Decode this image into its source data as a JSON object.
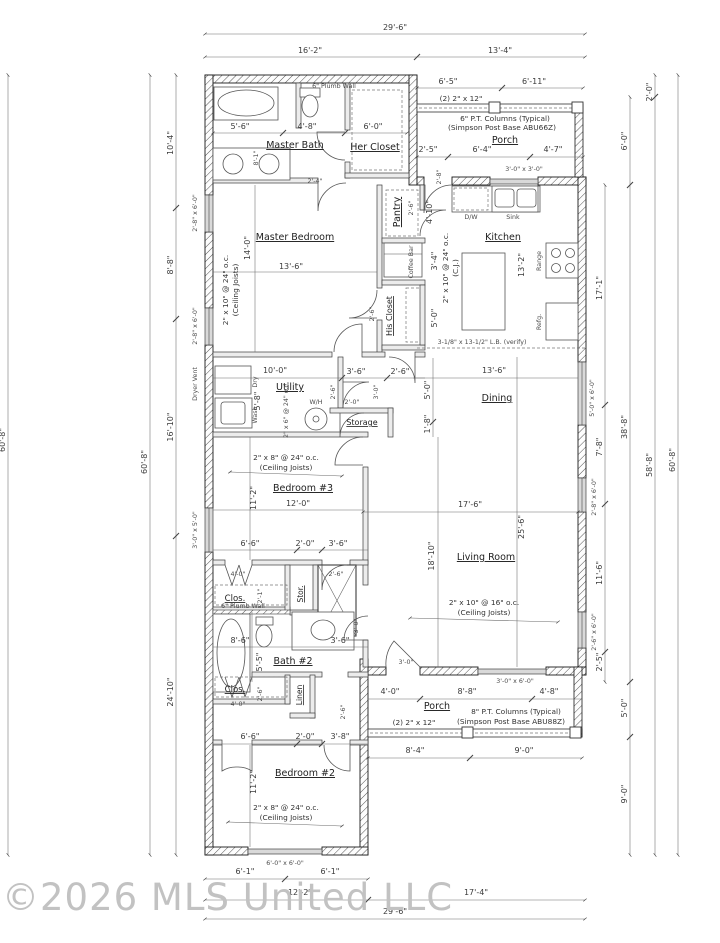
{
  "watermark": "©2026 MLS United LLC",
  "rooms": {
    "master_bath": "Master Bath",
    "her_closet": "Her Closet",
    "master_bedroom": "Master Bedroom",
    "pantry": "Pantry",
    "coffee_bar": "Coffee Bar",
    "his_closet": "His Closet",
    "kitchen": "Kitchen",
    "utility": "Utility",
    "storage": "Storage",
    "dining": "Dining",
    "bedroom3": "Bedroom #3",
    "living_room": "Living Room",
    "closet_top": "Clos.",
    "stor": "Stor.",
    "bath2": "Bath #2",
    "closet_bottom": "Clos.",
    "linen": "Linen",
    "bedroom2": "Bedroom #2",
    "porch_front": "Porch",
    "porch_rear": "Porch"
  },
  "fixtures": {
    "dw": "D/W",
    "sink": "Sink",
    "range": "Range",
    "fridge": "Refg.",
    "water_heater": "W/H",
    "dryer": "Dry",
    "washer": "Wash",
    "dryer_vent": "Dryer Vent"
  },
  "notes": {
    "plumb_wall_top": "6\" Plumb Wall",
    "plumb_wall_mid": "6\" Plumb Wall",
    "beam_front": "(2) 2\" x 12\"",
    "beam_rear": "(2) 2\" x 12\"",
    "col_front_1": "6\" P.T. Columns (Typical)",
    "col_front_2": "(Simpson Post Base ABU66Z)",
    "col_rear_1": "8\" P.T. Columns (Typical)",
    "col_rear_2": "(Simpson Post Base ABU88Z)",
    "lb": "3-1/8\" x 13-1/2\" L.B. (verify)",
    "j_mbr_1": "2\" x 10\" @ 24\" o.c.",
    "j_mbr_2": "(Ceiling Joists)",
    "j_k_1": "2\" x 10\" @ 24\" o.c.",
    "j_k_2": "(C.J.)",
    "j_u": "2\" x 6\" @ 24\" o.c.",
    "j_b3_1": "2\" x 8\" @ 24\" o.c.",
    "j_b3_2": "(Ceiling Joists)",
    "j_lv_1": "2\" x 10\" @ 16\" o.c.",
    "j_lv_2": "(Ceiling Joists)",
    "j_b2_1": "2\" x 8\" @ 24\" o.c.",
    "j_b2_2": "(Ceiling Joists)"
  },
  "windows": {
    "front_3030": "3'-0\" x 3'-0\"",
    "mbr_w1": "2'-8\" x 6'-0\"",
    "mbr_w2": "2'-8\" x 6'-0\"",
    "b3_w": "3'-0\" x 5'-0\"",
    "dining_w": "5'-0\" x 6'-0\"",
    "living_e1": "2'-8\" x 6'-0\"",
    "living_e2": "2'-6\" x 6'-0\"",
    "living_s": "3'-0\" x 6'-0\"",
    "b2_w": "6'-0\" x 6'-0\""
  },
  "dims": {
    "top_total": "29'-6\"",
    "top_left": "16'-2\"",
    "top_right": "13'-4\"",
    "fp_a": "6'-5\"",
    "fp_b": "6'-11\"",
    "fp_c": "2'-5\"",
    "fp_d": "6'-4\"",
    "fp_e": "4'-7\"",
    "r2_0": "2'-0\"",
    "r6_0": "6'-0\"",
    "r17_1": "17'-1\"",
    "r7_8": "7'-8\"",
    "r11_6": "11'-6\"",
    "r2_5": "2'-5\"",
    "r38_8": "38'-8\"",
    "r5_0": "5'-0\"",
    "r9_0": "9'-0\"",
    "r58_8": "58'-8\"",
    "r60_8": "60'-8\"",
    "l60_8a": "60'-8\"",
    "l60_8b": "60'-8\"",
    "l10_4": "10'-4\"",
    "l8_8": "8'-8\"",
    "l16_10": "16'-10\"",
    "l24_10": "24'-10\"",
    "bp8_4": "8'-4\"",
    "bp9_0": "9'-0\"",
    "b6_1a": "6'-1\"",
    "b6_1b": "6'-1\"",
    "b12_2": "12'-2\"",
    "b17_4": "17'-4\"",
    "b29_6": "29'-6\"",
    "mb5_6": "5'-6\"",
    "mb4_8": "4'-8\"",
    "mb6_0": "6'-0\"",
    "mb8_1": "8'-1\"",
    "mb2_4": "2'-4\"",
    "mbr14_0": "14'-0\"",
    "mbr13_6": "13'-6\"",
    "p2_6": "2'-6\"",
    "p4_10": "4'-10\"",
    "cb3_4": "3'-4\"",
    "hc2_6": "2'-6\"",
    "hc5_0": "5'-0\"",
    "k13_2": "13'-2\"",
    "k2_8": "2'-8\"",
    "u10_0": "10'-0\"",
    "u5_8": "5'-8\"",
    "h3_6": "3'-6\"",
    "h2_6": "2'-6\"",
    "hd2_6": "2'-6\"",
    "hd3_0": "3'-0\"",
    "st2_0": "2'-0\"",
    "v5_0": "5'-0\"",
    "v1_8": "1'-8\"",
    "d13_6": "13'-6\"",
    "d17_6": "17'-6\"",
    "d25_6": "25'-6\"",
    "b3_11_2": "11'-2\"",
    "b3_12_0": "12'-0\"",
    "lv18_10": "18'-10\"",
    "lvd3_0": "3'-0\"",
    "c6_6": "6'-6\"",
    "c2_0": "2'-0\"",
    "c3_6": "3'-6\"",
    "c4_0": "4'-0\"",
    "cd2_6": "2'-6\"",
    "c2_1": "2'-1\"",
    "bt8_6": "8'-6\"",
    "bt5_5": "5'-5\"",
    "bt3_6": "3'-6\"",
    "cl2_6": "2'-6\"",
    "cl4_0": "4'-0\"",
    "hs3_0": "3'-0\"",
    "d2_2_6": "2'-6\"",
    "cb6_6": "6'-6\"",
    "cb2_0": "2'-0\"",
    "cb3_8": "3'-8\"",
    "rp4_0": "4'-0\"",
    "rp8_8": "8'-8\"",
    "rp4_8": "4'-8\"",
    "b2_11_2": "11'-2\""
  }
}
